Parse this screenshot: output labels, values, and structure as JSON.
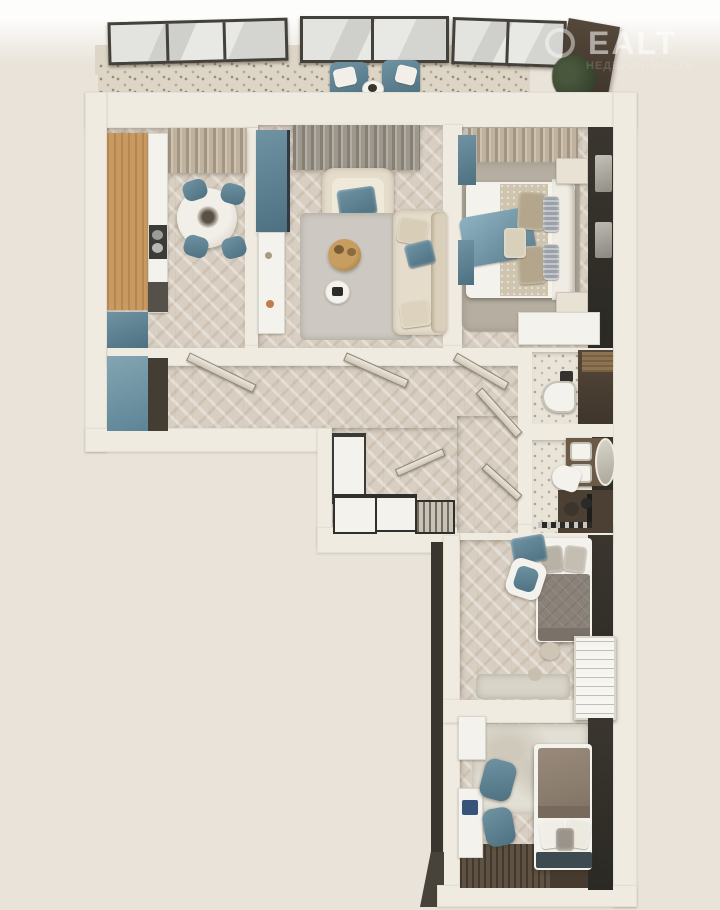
{
  "meta": {
    "kind": "3D rendered top-down floor plan of a multi-room apartment",
    "view": "orthographic top view, L-shaped layout"
  },
  "watermark": {
    "line1": "EALT",
    "line2": "НЕДВИЖИМОСТЬ"
  },
  "palette": {
    "bg_top": "#fdfdfc",
    "bg": "#e9e3d9",
    "wall": "#f0ebe1",
    "wall_shade": "#ddd5c6",
    "parquet": "#d8cfc2",
    "terrazzo": "#ddd5c5",
    "terrazzo_bath": "#eae4d8",
    "accent_teal": "#6f93a3",
    "accent_teal_dark": "#4e7181",
    "wood": "#c89a61",
    "charcoal": "#34312b",
    "dark_brown": "#4c4034",
    "sofa_beige": "#e5dccb",
    "furn_white": "#f4f2ec",
    "rug_grey": "#b5aea1",
    "rug_light": "#cdc9c2",
    "curtain_grey": "#9e978b",
    "curtain_beige": "#c0b29c",
    "duvet_bedroom2": "#8a8279",
    "duvet_bedroom3": "#8b7e6e",
    "dark_floor": "#5f5242",
    "window_frame": "#44403a",
    "plant_green": "#3c4a33"
  },
  "rooms": [
    {
      "id": "balcony",
      "furniture": [
        "windows",
        "lounge-chair",
        "lounge-chair",
        "side-table",
        "plant"
      ]
    },
    {
      "id": "kitchen-dining-room",
      "furniture": [
        "kitchen-cabinets",
        "cooktop",
        "round-dining-table",
        "chair",
        "chair",
        "chair",
        "chair",
        "curtain",
        "base-cabinet"
      ]
    },
    {
      "id": "living-room",
      "furniture": [
        "tall-cabinet",
        "console",
        "curtain",
        "armchair",
        "rug",
        "coffee-table",
        "side-table",
        "sofa"
      ]
    },
    {
      "id": "master-bedroom",
      "furniture": [
        "curtain",
        "rug",
        "double-bed",
        "nightstand",
        "nightstand",
        "wardrobe-dark",
        "dresser"
      ]
    },
    {
      "id": "hallway",
      "furniture": [
        "wardrobe",
        "open-doors"
      ]
    },
    {
      "id": "walk-in-closet",
      "furniture": [
        "shelving-unit",
        "drawer-units",
        "bench"
      ]
    },
    {
      "id": "wc",
      "furniture": [
        "toilet",
        "wall-shelf"
      ]
    },
    {
      "id": "bathroom",
      "furniture": [
        "double-sink-vanity",
        "oval-mirror",
        "bidet",
        "shower-area",
        "towel-rail"
      ]
    },
    {
      "id": "bedroom-2",
      "furniture": [
        "single-bed",
        "lounge-chair",
        "armchair",
        "poufs",
        "white-rack",
        "rug"
      ]
    },
    {
      "id": "bedroom-3",
      "furniture": [
        "single-bed",
        "desk",
        "desk-chair",
        "desk-chair",
        "rug",
        "dark-floor-mat"
      ]
    }
  ]
}
